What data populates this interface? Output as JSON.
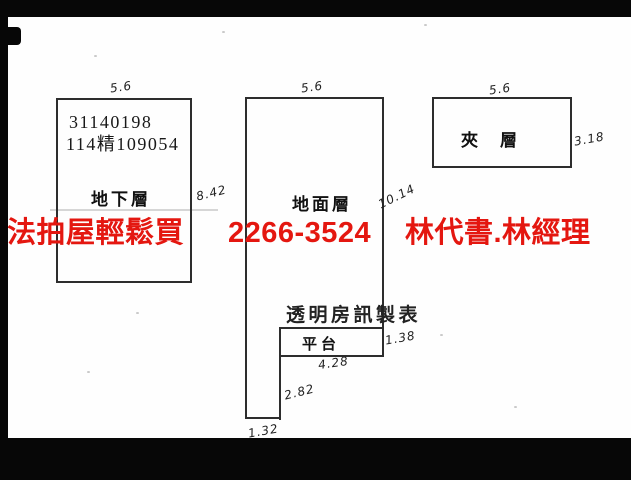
{
  "watermark": {
    "part1": "法拍屋輕鬆買",
    "part2": "2266-3524",
    "part3": "林代書.林經理",
    "color": "#e41710"
  },
  "basement": {
    "top_dim": "5.6",
    "id_line1": "31140198",
    "id_line2": "114精109054",
    "label": "地下層",
    "right_dim": "8.42"
  },
  "ground": {
    "top_dim": "5.6",
    "label": "地面層",
    "right_dim": "10.14",
    "credit": "透明房訊製表",
    "platform_label": "平台",
    "platform_right_dim": "1.38",
    "platform_bottom_dim": "4.28",
    "foot_right_dim": "2.82",
    "foot_bottom_dim": "1.32"
  },
  "mezzanine": {
    "top_dim": "5.6",
    "label": "夾層",
    "right_dim": "3.18"
  },
  "ink_color": "#2d2d2d",
  "edge_color": "#070707"
}
